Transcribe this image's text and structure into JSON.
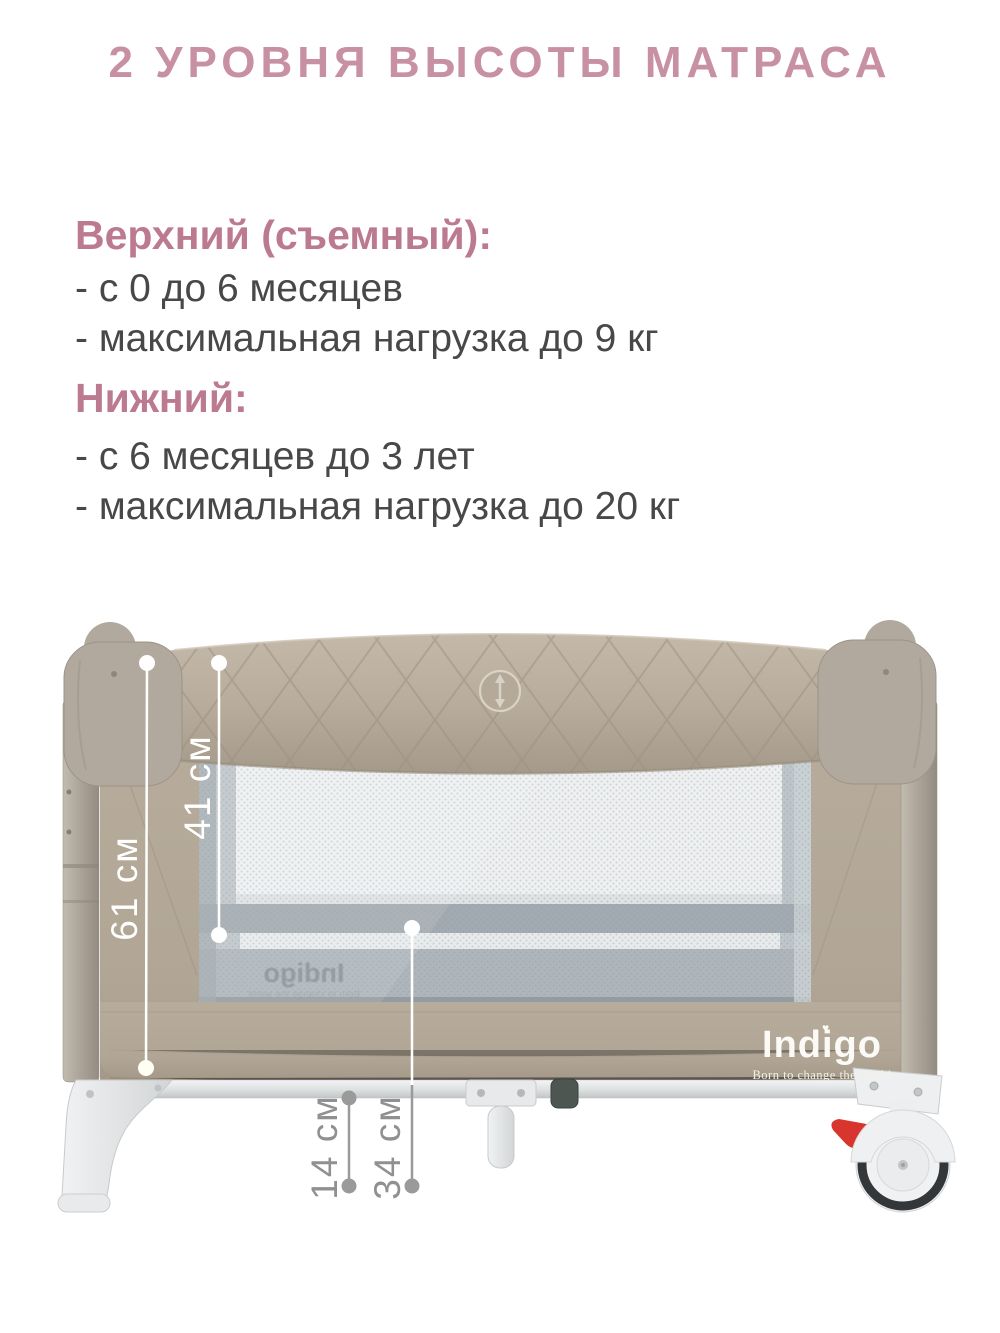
{
  "page": {
    "title": "2 УРОВНЯ ВЫСОТЫ МАТРАСА"
  },
  "info": {
    "sections": [
      {
        "heading": "Верхний (съемный):",
        "items": [
          "- с 0 до 6 месяцев",
          "- максимальная нагрузка до 9 кг"
        ]
      },
      {
        "heading": "Нижний:",
        "items": [
          "- с 6 месяцев до 3 лет",
          "- максимальная нагрузка до 20 кг"
        ]
      }
    ]
  },
  "product": {
    "brand": "Indigo",
    "brand_tagline": "Born to change the world",
    "brand_mirrored": "Indigo",
    "brand_heart": "♥"
  },
  "measurements": {
    "upper_mattress_depth": "41 см",
    "side_total_height": "61 см",
    "leg_clearance": "14 см",
    "lower_level_height": "34 см"
  },
  "icons": {
    "rail_emblem": "up-down-arrow-icon",
    "brand_heart": "heart-icon"
  },
  "colors": {
    "title_pink": "#c890a3",
    "heading_pink": "#bc7a90",
    "body_text": "#484848",
    "fabric_taupe": "#b2a796",
    "rail_taupe": "#b8ad9d",
    "mesh_gray": "#bfc6ca",
    "frame_white": "#eceeef",
    "wheel_tire": "#33373a",
    "brake_red": "#d8352e",
    "label_white": "#ffffff",
    "label_gray": "#909090"
  }
}
